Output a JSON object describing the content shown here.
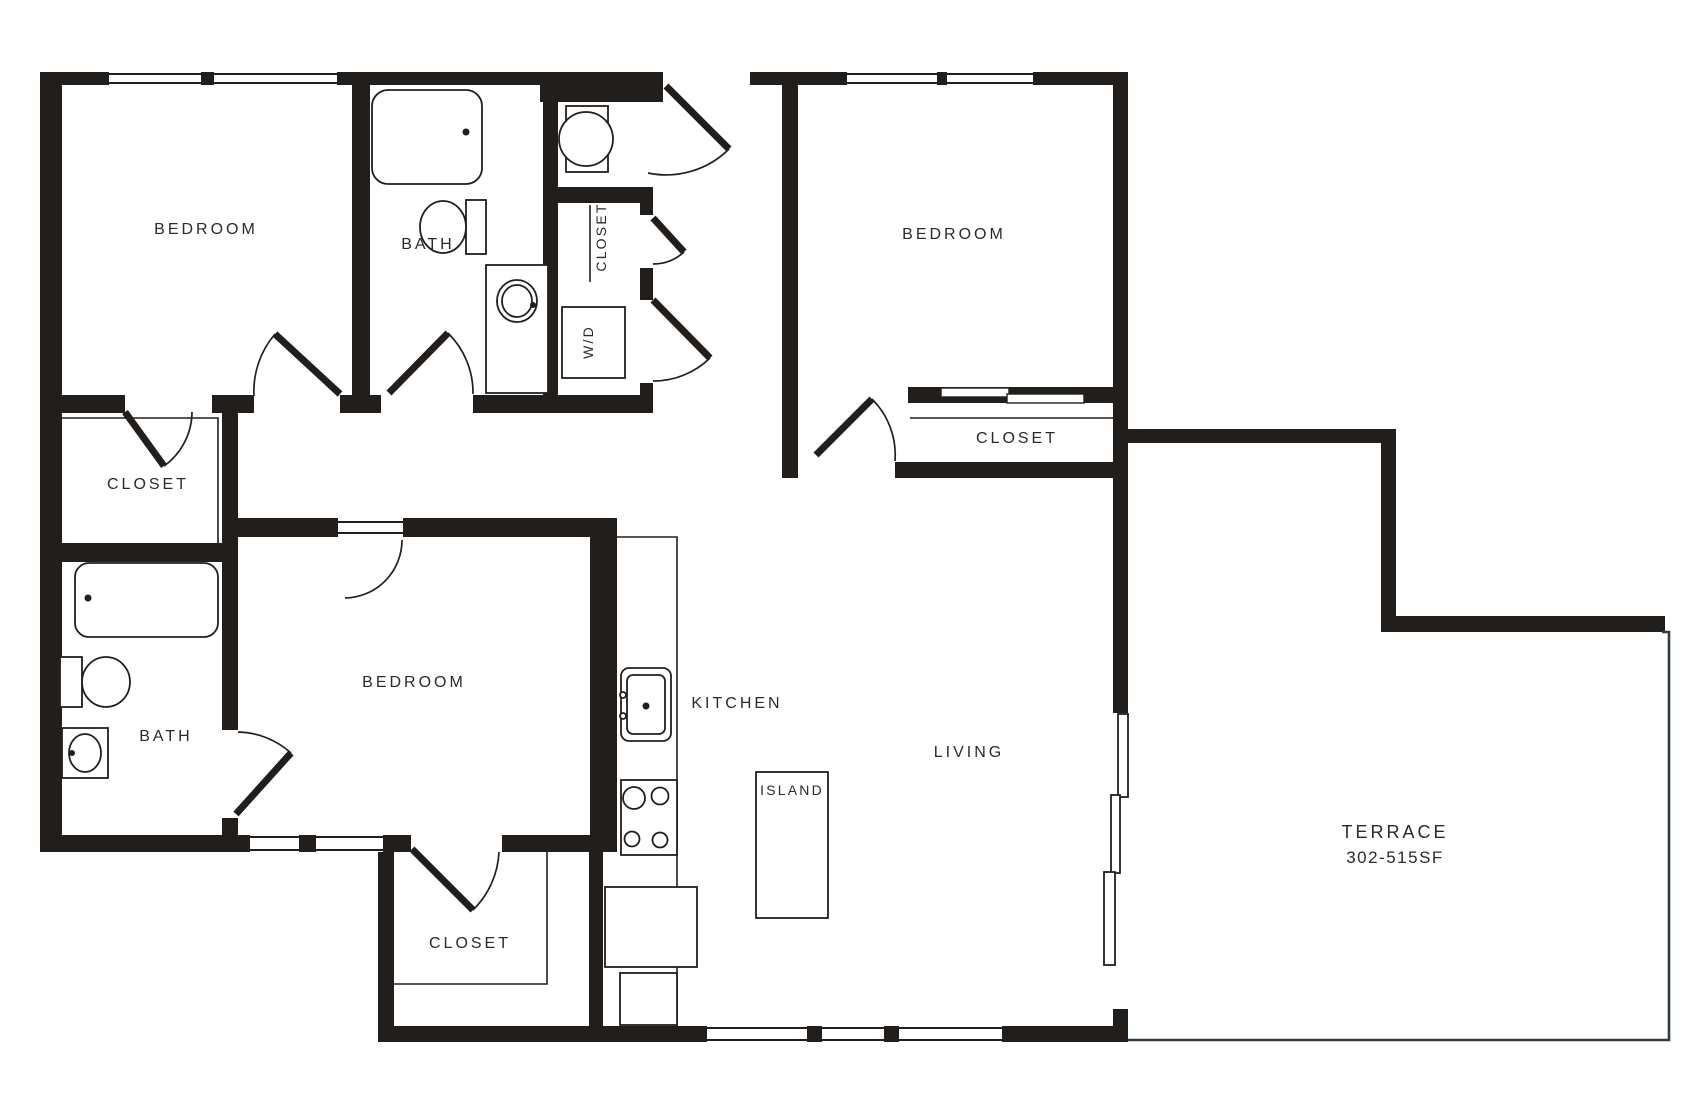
{
  "colors": {
    "wall": "#221e1b",
    "line": "#2b2a28",
    "terrace_line": "#313c42",
    "background": "#ffffff",
    "text": "#2b2a28"
  },
  "rooms": {
    "bedroom_top_left": {
      "label": "BEDROOM"
    },
    "bath_top": {
      "label": "BATH"
    },
    "closet_niche": {
      "label": "CLOSET"
    },
    "laundry": {
      "label": "W/D"
    },
    "bedroom_top_right": {
      "label": "BEDROOM"
    },
    "closet_top_right": {
      "label": "CLOSET"
    },
    "closet_bedroom_left": {
      "label": "CLOSET"
    },
    "bath_bottom": {
      "label": "BATH"
    },
    "bedroom_bottom": {
      "label": "BEDROOM"
    },
    "closet_bottom": {
      "label": "CLOSET"
    },
    "kitchen": {
      "label": "KITCHEN"
    },
    "island": {
      "label": "ISLAND"
    },
    "living": {
      "label": "LIVING"
    },
    "terrace": {
      "label": "TERRACE",
      "area": "302-515SF"
    }
  }
}
